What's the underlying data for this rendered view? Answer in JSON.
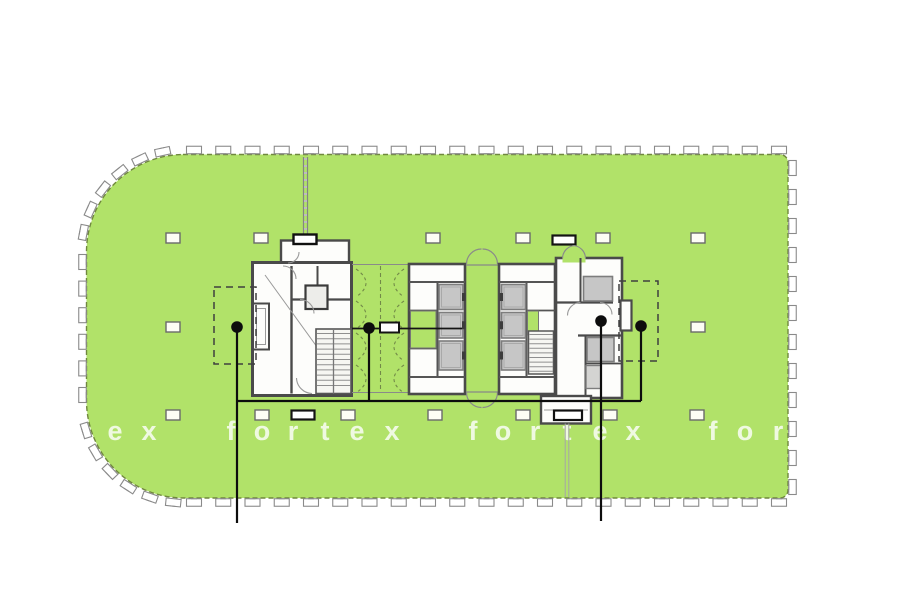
{
  "document": {
    "type": "architectural-floor-plan",
    "background": "#ffffff"
  },
  "colors": {
    "plate_green": "#b1e269",
    "facade_line": "#70883e",
    "wall_dark": "#4a4a4a",
    "wall_mid": "#8a8a8a",
    "room_white": "#fdfdfb",
    "shaft_gray": "#c6c6c6",
    "stair_fill": "#f6f6f2",
    "callout_black": "#0d0d0d",
    "watermark_white": "rgba(255,255,255,0.8)"
  },
  "watermark": {
    "word": "fortex",
    "row_y": 431,
    "letters": [
      {
        "ch": "e",
        "x": 115
      },
      {
        "ch": "x",
        "x": 149
      },
      {
        "ch": "f",
        "x": 231
      },
      {
        "ch": "o",
        "x": 262
      },
      {
        "ch": "r",
        "x": 293
      },
      {
        "ch": "t",
        "x": 325
      },
      {
        "ch": "e",
        "x": 357
      },
      {
        "ch": "x",
        "x": 392
      },
      {
        "ch": "f",
        "x": 473
      },
      {
        "ch": "o",
        "x": 503
      },
      {
        "ch": "r",
        "x": 535
      },
      {
        "ch": "t",
        "x": 567
      },
      {
        "ch": "e",
        "x": 600
      },
      {
        "ch": "x",
        "x": 633
      },
      {
        "ch": "f",
        "x": 713
      },
      {
        "ch": "o",
        "x": 745
      },
      {
        "ch": "r",
        "x": 778
      }
    ]
  },
  "plan": {
    "columns": [
      {
        "y": 238,
        "xs": [
          173,
          261,
          433,
          523,
          603,
          698
        ]
      },
      {
        "y": 327,
        "xs": [
          173,
          698
        ]
      },
      {
        "y": 415,
        "xs": [
          173,
          262,
          348,
          435,
          523,
          610,
          697
        ]
      }
    ],
    "equipment_boxes": [
      {
        "x": 564,
        "y": 240
      },
      {
        "x": 303,
        "y": 415
      }
    ],
    "tenant_zones_dashed": [
      {
        "x": 214,
        "y": 287,
        "w": 42,
        "h": 77
      },
      {
        "x": 619,
        "y": 281,
        "w": 39,
        "h": 80
      }
    ],
    "callout_dots": [
      {
        "id": "A",
        "x": 237,
        "y": 327
      },
      {
        "id": "B",
        "x": 369,
        "y": 328
      },
      {
        "id": "C",
        "x": 601,
        "y": 321
      },
      {
        "id": "D",
        "x": 641,
        "y": 326
      }
    ],
    "callout_lines": [
      [
        [
          237,
          327
        ],
        [
          237,
          523
        ]
      ],
      [
        [
          369,
          328
        ],
        [
          369,
          401
        ]
      ],
      [
        [
          237,
          401
        ],
        [
          641,
          401
        ]
      ],
      [
        [
          641,
          326
        ],
        [
          641,
          401
        ]
      ],
      [
        [
          601,
          321
        ],
        [
          601,
          521
        ]
      ]
    ],
    "section_line": {
      "x1": 352,
      "x2": 462,
      "y": 328.5,
      "bar": {
        "x": 380,
        "y": 322.5,
        "w": 19,
        "h": 10
      }
    }
  }
}
